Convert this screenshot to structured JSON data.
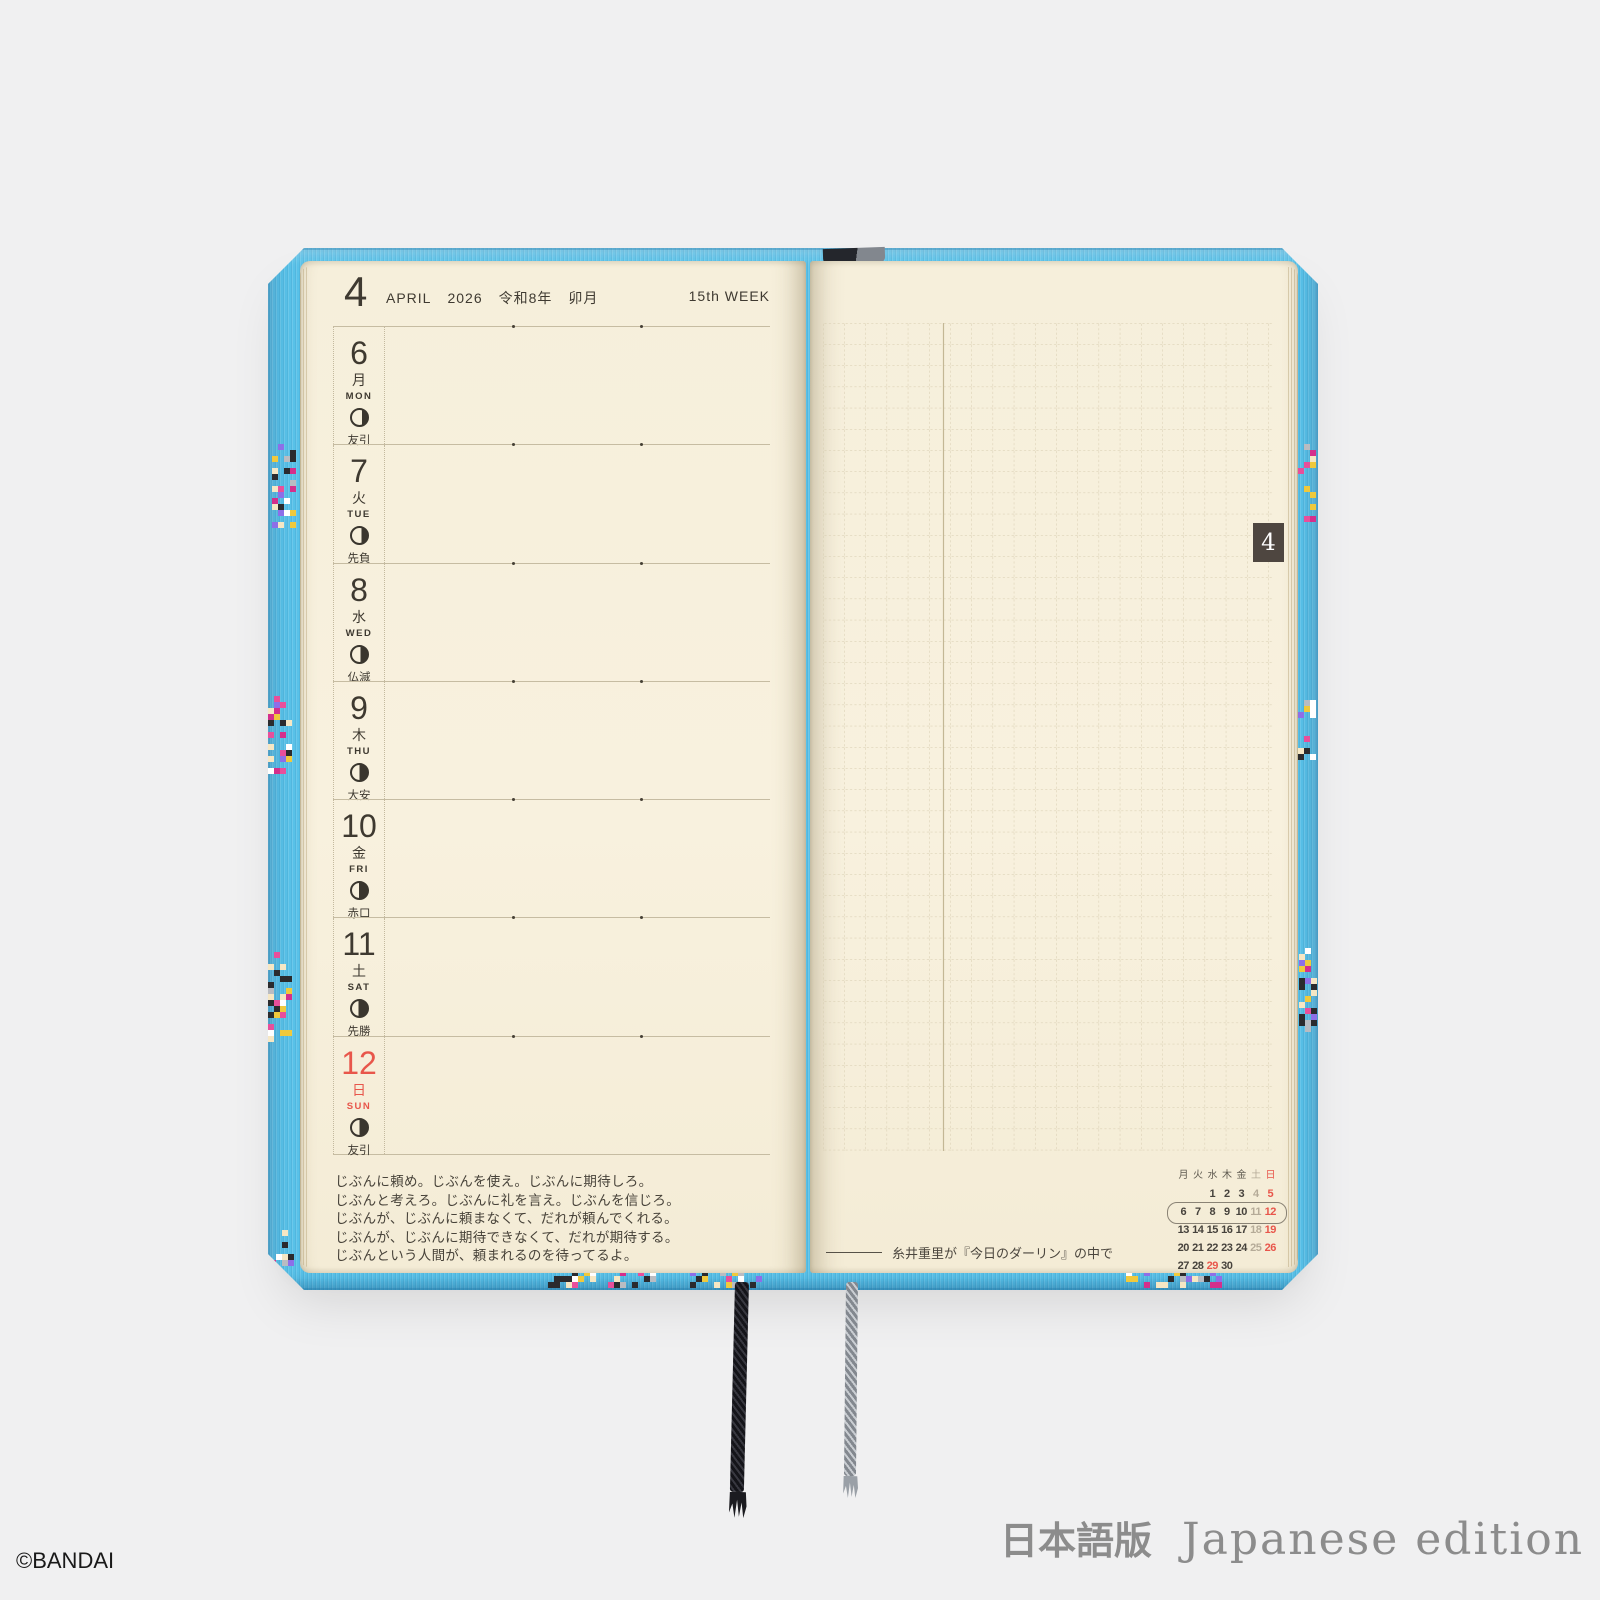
{
  "theme": {
    "background": "#f0f0f1",
    "cover_blue": "#58c1e8",
    "page_cream": "#f7f0dc",
    "ink": "#3e3930",
    "sunday_red": "#e8564b",
    "muted_gray": "#b5ab98",
    "tab_brown": "#4e4640",
    "grid_line": "#d6cbae"
  },
  "photo": {
    "copyright": "©BANDAI",
    "edition_ja": "日本語版",
    "edition_en": "Japanese edition"
  },
  "left_page": {
    "header": {
      "month_num": "4",
      "month_en": "APRIL",
      "year": "2026",
      "wareki": "令和8年",
      "kyureki": "卯月",
      "week_label": "15th WEEK"
    },
    "days": [
      {
        "date": "6",
        "kanji": "月",
        "en": "MON",
        "rokuyo": "友引",
        "moon_dark": 0.32,
        "is_sunday": false
      },
      {
        "date": "7",
        "kanji": "火",
        "en": "TUE",
        "rokuyo": "先負",
        "moon_dark": 0.38,
        "is_sunday": false
      },
      {
        "date": "8",
        "kanji": "水",
        "en": "WED",
        "rokuyo": "仏滅",
        "moon_dark": 0.45,
        "is_sunday": false
      },
      {
        "date": "9",
        "kanji": "木",
        "en": "THU",
        "rokuyo": "大安",
        "moon_dark": 0.5,
        "is_sunday": false
      },
      {
        "date": "10",
        "kanji": "金",
        "en": "FRI",
        "rokuyo": "赤口",
        "moon_dark": 0.52,
        "is_sunday": false
      },
      {
        "date": "11",
        "kanji": "土",
        "en": "SAT",
        "rokuyo": "先勝",
        "moon_dark": 0.58,
        "is_sunday": false
      },
      {
        "date": "12",
        "kanji": "日",
        "en": "SUN",
        "rokuyo": "友引",
        "moon_dark": 0.5,
        "is_sunday": true
      }
    ],
    "quote_lines": [
      "じぶんに頼め。じぶんを使え。じぶんに期待しろ。",
      "じぶんと考えろ。じぶんに礼を言え。じぶんを信じろ。",
      "じぶんが、じぶんに頼まなくて、だれが頼んでくれる。",
      "じぶんが、じぶんに期待できなくて、だれが期待する。",
      "じぶんという人間が、頼まれるのを待ってるよ。"
    ]
  },
  "right_page": {
    "month_tab": "4",
    "attribution": "糸井重里が『今日のダーリン』の中で",
    "mini_calendar": {
      "weekdays": [
        "月",
        "火",
        "水",
        "木",
        "金",
        "土",
        "日"
      ],
      "weeks": [
        [
          "",
          "",
          "1",
          "2",
          "3",
          "4",
          "5"
        ],
        [
          "6",
          "7",
          "8",
          "9",
          "10",
          "11",
          "12"
        ],
        [
          "13",
          "14",
          "15",
          "16",
          "17",
          "18",
          "19"
        ],
        [
          "20",
          "21",
          "22",
          "23",
          "24",
          "25",
          "26"
        ],
        [
          "27",
          "28",
          "29",
          "30",
          "",
          "",
          ""
        ]
      ],
      "red_days": [
        "29"
      ],
      "circled_week_index": 1
    }
  }
}
